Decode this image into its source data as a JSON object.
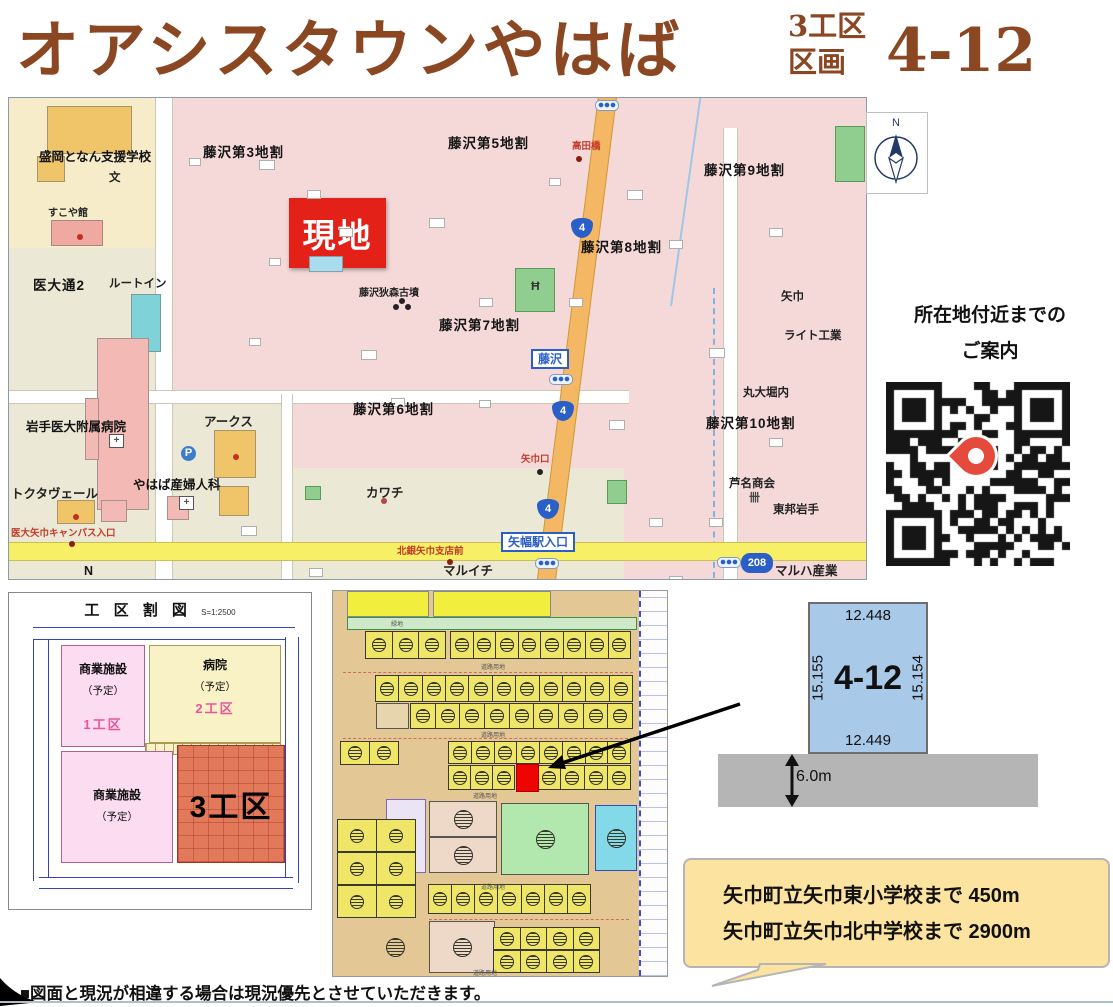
{
  "header": {
    "title": "オアシスタウンやはば",
    "zone_line1": "3工区",
    "zone_line2": "区画",
    "lot_number": "4-12",
    "title_color": "#8a4722"
  },
  "compass": {
    "n": "N"
  },
  "guide": {
    "line1": "所在地付近までの",
    "line2": "ご案内"
  },
  "main_map": {
    "site_label": "現地",
    "labels": [
      {
        "t": "盛岡となん支援学校",
        "x": 30,
        "y": 52,
        "c": "b13"
      },
      {
        "t": "文",
        "x": 100,
        "y": 74,
        "c": "p12"
      },
      {
        "t": "すこや館",
        "x": 39,
        "y": 110,
        "c": "s11"
      },
      {
        "t": "医大通2",
        "x": 24,
        "y": 180,
        "c": "b14"
      },
      {
        "t": "ルートイン",
        "x": 100,
        "y": 180,
        "c": "p12"
      },
      {
        "t": "藤沢第3地割",
        "x": 194,
        "y": 47,
        "c": "b14"
      },
      {
        "t": "藤沢第5地割",
        "x": 439,
        "y": 38,
        "c": "b14"
      },
      {
        "t": "高田橋",
        "x": 563,
        "y": 44,
        "c": "r10"
      },
      {
        "t": "藤沢第9地割",
        "x": 695,
        "y": 65,
        "c": "b14"
      },
      {
        "t": "藤沢第8地割",
        "x": 572,
        "y": 142,
        "c": "b14"
      },
      {
        "t": "藤沢狄森古墳",
        "x": 350,
        "y": 190,
        "c": "s11"
      },
      {
        "t": "藤沢第7地割",
        "x": 430,
        "y": 220,
        "c": "b14"
      },
      {
        "t": "矢巾",
        "x": 772,
        "y": 193,
        "c": "p12"
      },
      {
        "t": "ライト工業",
        "x": 775,
        "y": 232,
        "c": "p12"
      },
      {
        "t": "岩手医大附属病院",
        "x": 17,
        "y": 322,
        "c": "b13"
      },
      {
        "t": "アークス",
        "x": 195,
        "y": 317,
        "c": "p13"
      },
      {
        "t": "藤沢第6地割",
        "x": 344,
        "y": 304,
        "c": "b14"
      },
      {
        "t": "やはば産婦人科",
        "x": 124,
        "y": 380,
        "c": "b13"
      },
      {
        "t": "トクタヴェール",
        "x": 2,
        "y": 389,
        "c": "p13"
      },
      {
        "t": "カワチ",
        "x": 357,
        "y": 388,
        "c": "p13"
      },
      {
        "t": "丸大堀内",
        "x": 734,
        "y": 289,
        "c": "p12"
      },
      {
        "t": "藤沢第10地割",
        "x": 697,
        "y": 318,
        "c": "b14"
      },
      {
        "t": "芦名商会",
        "x": 720,
        "y": 380,
        "c": "p12"
      },
      {
        "t": "東邦岩手",
        "x": 764,
        "y": 406,
        "c": "p12"
      },
      {
        "t": "医大矢巾キャンパス入口",
        "x": 2,
        "y": 431,
        "c": "r10"
      },
      {
        "t": "矢巾口",
        "x": 512,
        "y": 357,
        "c": "r10"
      },
      {
        "t": "北銀矢巾支店前",
        "x": 388,
        "y": 449,
        "c": "r10"
      },
      {
        "t": "マルイチ",
        "x": 434,
        "y": 466,
        "c": "p13"
      },
      {
        "t": "マルハ産業",
        "x": 766,
        "y": 466,
        "c": "p13"
      },
      {
        "t": "N",
        "x": 75,
        "y": 466,
        "c": "b13"
      }
    ],
    "icons": [
      {
        "g": "+",
        "x": 100,
        "y": 336,
        "c": "ic-h"
      },
      {
        "g": "+",
        "x": 170,
        "y": 398,
        "c": "ic-h"
      },
      {
        "g": "P",
        "x": 172,
        "y": 348,
        "c": "ic-p"
      },
      {
        "g": "卌",
        "x": 740,
        "y": 394,
        "c": "ic-f"
      },
      {
        "g": "Ħ",
        "x": 522,
        "y": 182,
        "c": "ic-t"
      }
    ],
    "blue_labels": [
      {
        "t": "藤沢",
        "x": 522,
        "y": 251
      },
      {
        "t": "矢幅駅入口",
        "x": 492,
        "y": 434
      }
    ],
    "shields": [
      {
        "n": "4",
        "x": 562,
        "y": 120
      },
      {
        "n": "4",
        "x": 543,
        "y": 303
      },
      {
        "n": "4",
        "x": 528,
        "y": 401
      },
      {
        "n": "208",
        "x": 732,
        "y": 455
      }
    ],
    "signals": [
      [
        586,
        2
      ],
      [
        540,
        276
      ],
      [
        526,
        460
      ],
      [
        708,
        459
      ]
    ],
    "buildings": [
      [
        38,
        8,
        85,
        48,
        "#f0c469"
      ],
      [
        28,
        58,
        28,
        26,
        "#f0c469"
      ],
      [
        42,
        122,
        52,
        26,
        "#efa9a0"
      ],
      [
        122,
        196,
        30,
        58,
        "#7fd3d8"
      ],
      [
        88,
        240,
        52,
        172,
        "#f3b9b4"
      ],
      [
        76,
        300,
        14,
        62,
        "#f3b9b4"
      ],
      [
        48,
        402,
        38,
        24,
        "#f0c469"
      ],
      [
        92,
        402,
        26,
        22,
        "#f3b9b4"
      ],
      [
        205,
        332,
        42,
        48,
        "#f0c469"
      ],
      [
        210,
        388,
        30,
        30,
        "#f0c469"
      ],
      [
        158,
        398,
        22,
        24,
        "#f3b9b4"
      ],
      [
        300,
        158,
        34,
        16,
        "#aadcf0"
      ],
      [
        250,
        62,
        16,
        10,
        "#ffffff"
      ],
      [
        298,
        92,
        14,
        9,
        "#ffffff"
      ],
      [
        420,
        120,
        16,
        10,
        "#ffffff"
      ],
      [
        470,
        200,
        14,
        9,
        "#ffffff"
      ],
      [
        618,
        92,
        16,
        10,
        "#ffffff"
      ],
      [
        660,
        142,
        14,
        9,
        "#ffffff"
      ],
      [
        700,
        250,
        16,
        10,
        "#ffffff"
      ],
      [
        760,
        130,
        14,
        9,
        "#ffffff"
      ],
      [
        352,
        252,
        16,
        10,
        "#ffffff"
      ],
      [
        382,
        300,
        14,
        9,
        "#ffffff"
      ],
      [
        600,
        322,
        16,
        10,
        "#ffffff"
      ],
      [
        640,
        420,
        14,
        9,
        "#ffffff"
      ],
      [
        232,
        428,
        16,
        10,
        "#ffffff"
      ],
      [
        700,
        420,
        14,
        9,
        "#ffffff"
      ],
      [
        560,
        200,
        14,
        9,
        "#ffffff"
      ],
      [
        470,
        302,
        12,
        8,
        "#ffffff"
      ],
      [
        330,
        130,
        14,
        9,
        "#ffffff"
      ],
      [
        260,
        160,
        12,
        8,
        "#ffffff"
      ],
      [
        540,
        80,
        12,
        8,
        "#ffffff"
      ],
      [
        760,
        340,
        14,
        9,
        "#ffffff"
      ],
      [
        660,
        478,
        14,
        9,
        "#ffffff"
      ],
      [
        300,
        470,
        14,
        9,
        "#ffffff"
      ],
      [
        240,
        240,
        12,
        8,
        "#ffffff"
      ],
      [
        180,
        60,
        12,
        8,
        "#ffffff"
      ]
    ],
    "greens": [
      [
        506,
        170,
        40,
        44
      ],
      [
        826,
        28,
        30,
        56
      ],
      [
        598,
        382,
        20,
        24
      ],
      [
        296,
        388,
        16,
        14
      ]
    ],
    "dots": [
      [
        68,
        136,
        "#c03020"
      ],
      [
        224,
        356,
        "#c03020"
      ],
      [
        64,
        416,
        "#c03020"
      ],
      [
        372,
        400,
        "#b04848"
      ],
      [
        567,
        58,
        "#8a1f10"
      ],
      [
        528,
        371,
        "#222222"
      ],
      [
        60,
        443,
        "#8a1f10"
      ],
      [
        438,
        461,
        "#8a1f10"
      ],
      [
        390,
        200,
        "#222222"
      ],
      [
        396,
        206,
        "#222222"
      ],
      [
        384,
        206,
        "#222222"
      ]
    ]
  },
  "kouku_map": {
    "title": "工 区 割 図",
    "scale": "S=1:2500",
    "block1_name": "商業施設",
    "block1_sub": "（予定）",
    "block1_zone": "1工区",
    "block2_name": "病院",
    "block2_sub": "（予定）",
    "block2_zone": "2工区",
    "block3_name": "商業施設",
    "block3_sub": "（予定）",
    "block4_zone": "3工区"
  },
  "middle_plat": {
    "rows": [
      [
        33,
        40,
        80,
        28,
        3
      ],
      [
        118,
        40,
        180,
        28,
        8
      ],
      [
        43,
        84,
        257,
        27,
        11
      ],
      [
        78,
        112,
        222,
        26,
        9
      ],
      [
        8,
        150,
        58,
        24,
        2
      ],
      [
        116,
        150,
        182,
        23,
        8
      ],
      [
        116,
        174,
        66,
        25,
        3
      ],
      [
        205,
        174,
        93,
        25,
        4
      ],
      [
        5,
        228,
        78,
        33,
        2
      ],
      [
        5,
        261,
        78,
        33,
        2
      ],
      [
        5,
        294,
        78,
        33,
        2
      ],
      [
        96,
        293,
        162,
        30,
        7
      ],
      [
        161,
        336,
        106,
        23,
        4
      ],
      [
        161,
        359,
        106,
        23,
        4
      ]
    ],
    "blocks": [
      {
        "x": 14,
        "y": 0,
        "w": 82,
        "h": 26,
        "cls": "yb"
      },
      {
        "x": 100,
        "y": 0,
        "w": 118,
        "h": 26,
        "cls": "yb"
      },
      {
        "x": 14,
        "y": 26,
        "w": 290,
        "h": 13,
        "cls": "gs"
      },
      {
        "x": 306,
        "y": 0,
        "w": 28,
        "h": 385,
        "cls": "cad"
      },
      {
        "x": 43,
        "y": 112,
        "w": 33,
        "h": 26,
        "cls": "tan"
      },
      {
        "x": 53,
        "y": 208,
        "w": 40,
        "h": 74,
        "cls": "lav"
      },
      {
        "x": 96,
        "y": 210,
        "w": 68,
        "h": 36,
        "cls": "pk",
        "g": 1
      },
      {
        "x": 96,
        "y": 246,
        "w": 68,
        "h": 36,
        "cls": "pk",
        "g": 1
      },
      {
        "x": 96,
        "y": 330,
        "w": 66,
        "h": 52,
        "cls": "pk",
        "g": 1
      },
      {
        "x": 168,
        "y": 212,
        "w": 88,
        "h": 72,
        "cls": "gr",
        "g": 1
      },
      {
        "x": 262,
        "y": 214,
        "w": 42,
        "h": 66,
        "cls": "cy",
        "g": 1
      },
      {
        "x": 40,
        "y": 336,
        "w": 44,
        "h": 40,
        "cls": "tan2",
        "g": 1
      }
    ],
    "labels": [
      [
        "緑地",
        58,
        28
      ],
      [
        "道路用地",
        148,
        71
      ],
      [
        "道路用地",
        148,
        139
      ],
      [
        "道路用地",
        140,
        200
      ],
      [
        "道路用地",
        148,
        291
      ],
      [
        "道路用地",
        140,
        377
      ]
    ]
  },
  "lot_diagram": {
    "id": "4-12",
    "top": "12.448",
    "bottom": "12.449",
    "left": "15.155",
    "right": "15.154",
    "road": "6.0m"
  },
  "bubble": {
    "line1": "矢巾町立矢巾東小学校まで 450m",
    "line2": "矢巾町立矢巾北中学校まで 2900m"
  },
  "footer": {
    "note": "■図面と現況が相違する場合は現況優先とさせていただきます。"
  }
}
